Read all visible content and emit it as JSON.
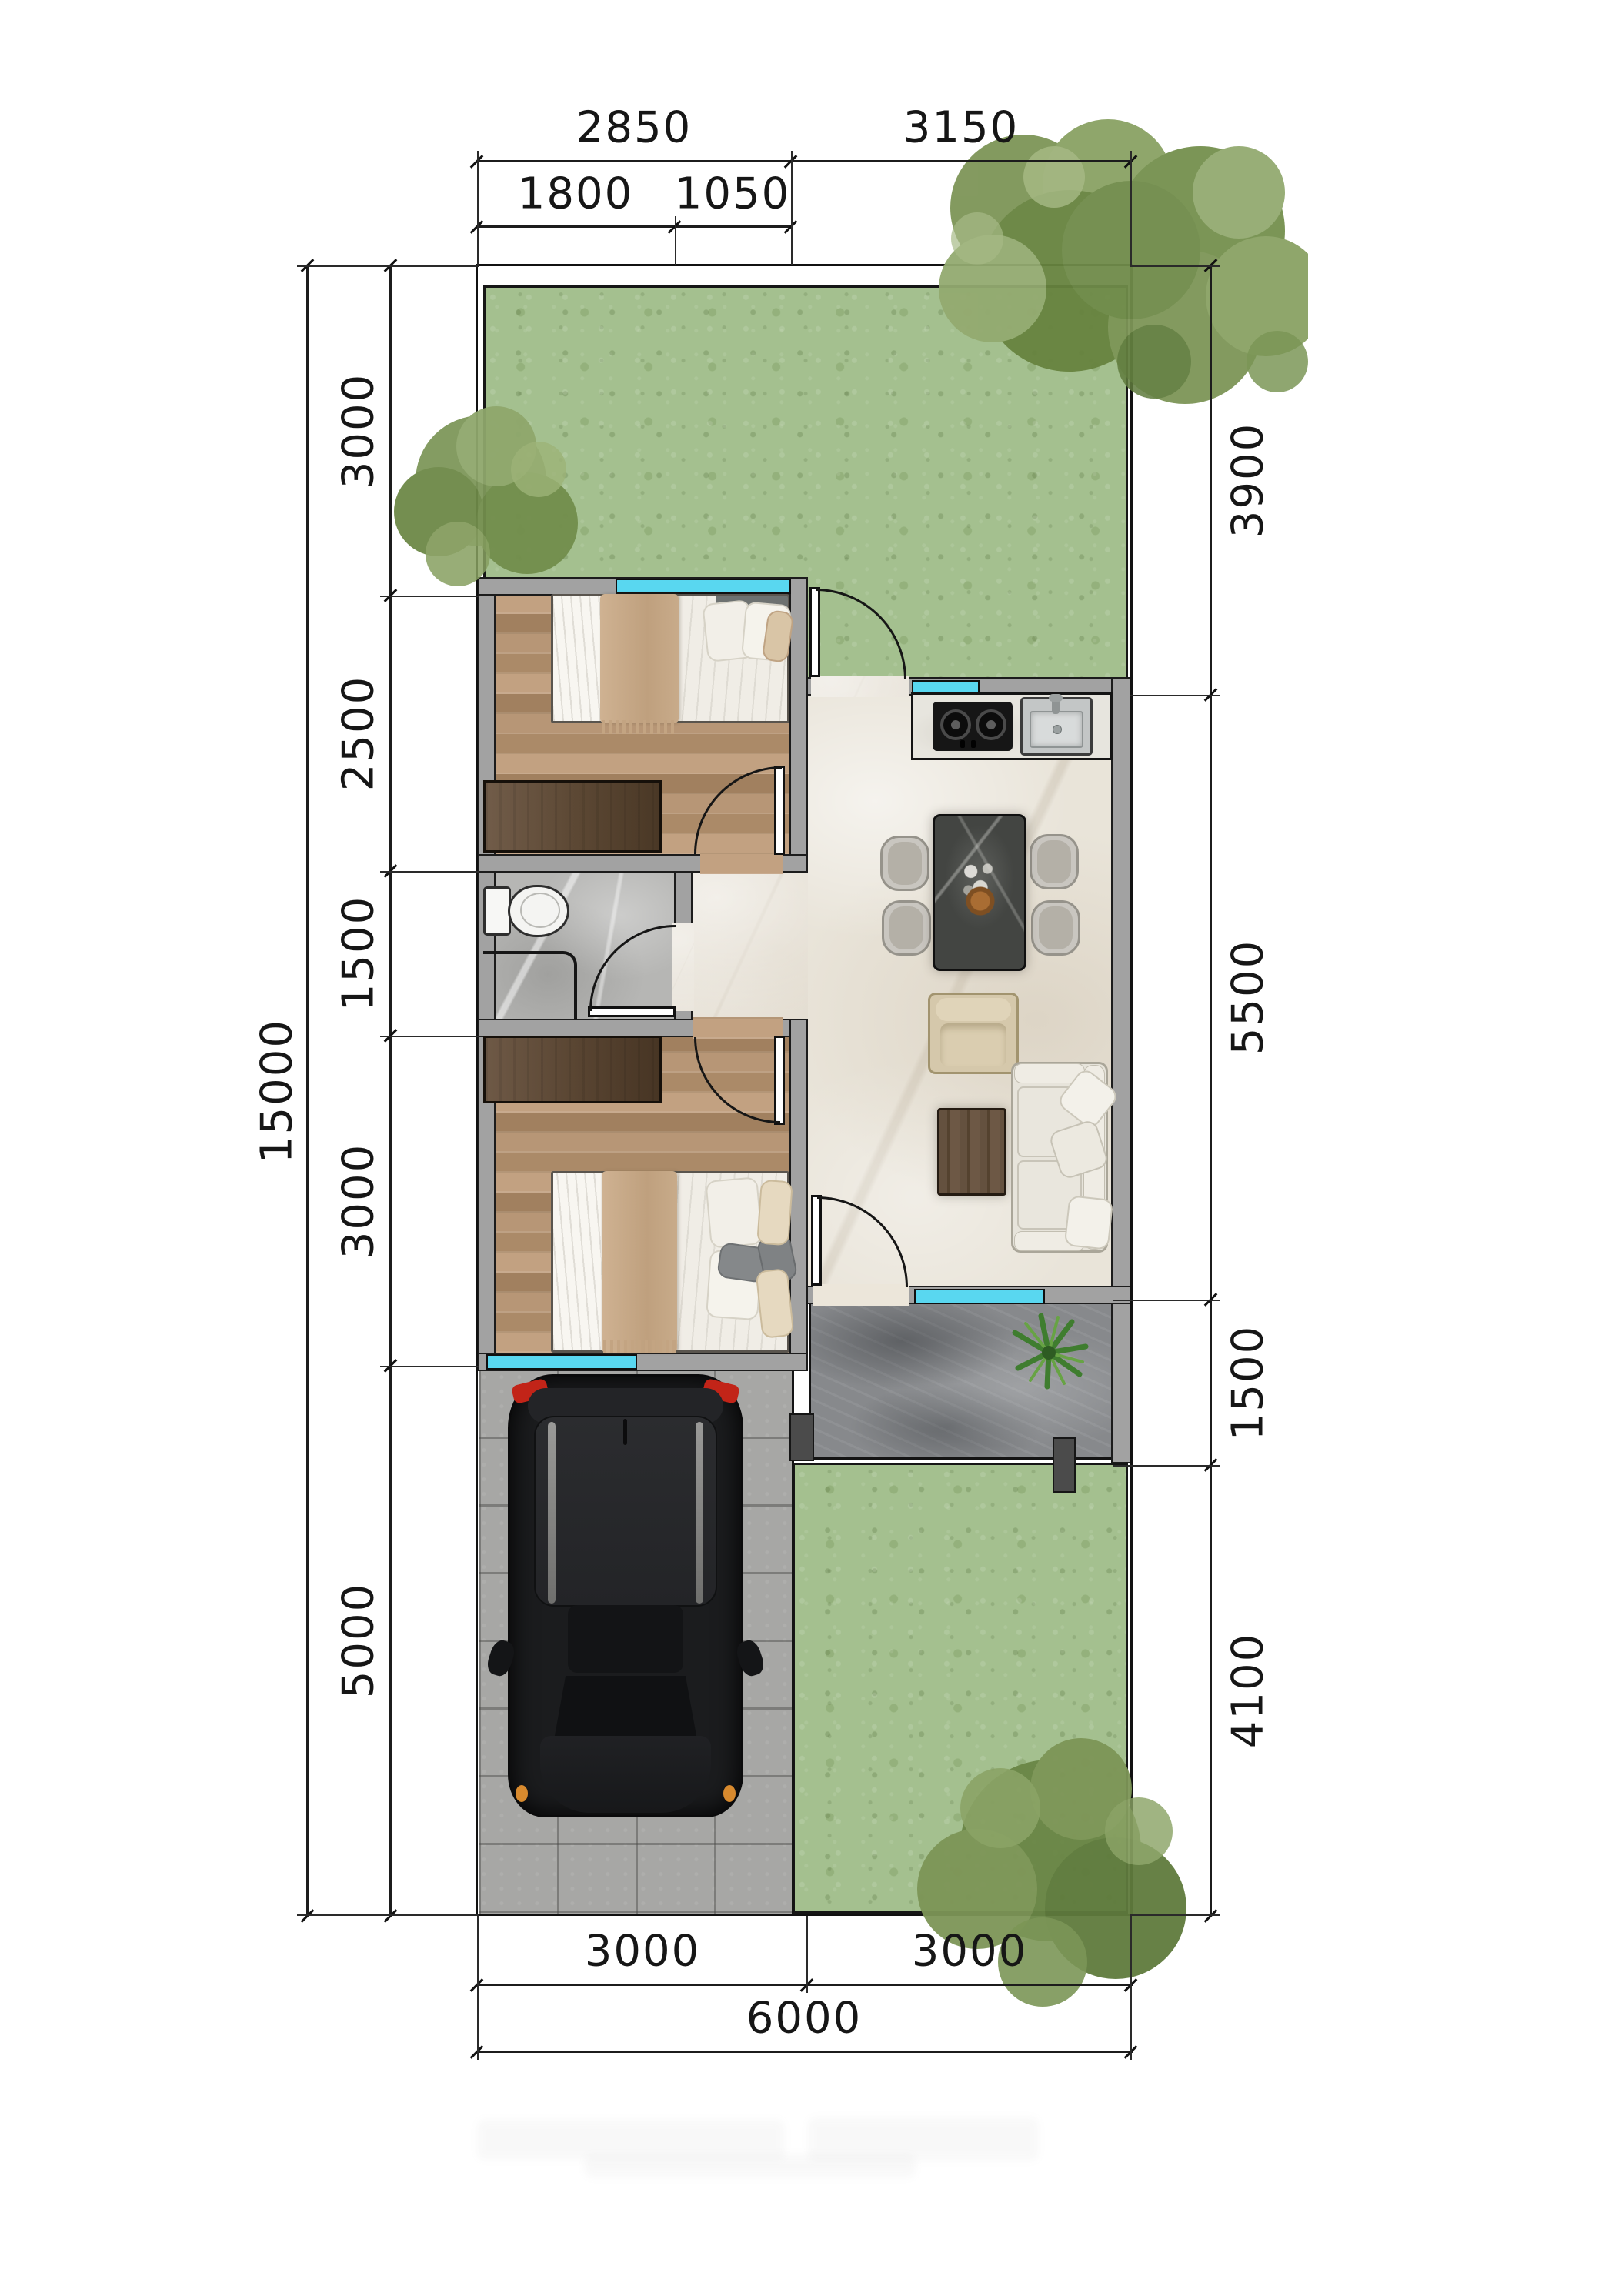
{
  "dims": {
    "top_row1": [
      "2850",
      "3150"
    ],
    "top_row2": [
      "1800",
      "1050"
    ],
    "left_overall": "15000",
    "left_segments": [
      "3000",
      "2500",
      "1500",
      "3000",
      "5000"
    ],
    "right_segments": [
      "3900",
      "5500",
      "1500",
      "4100"
    ],
    "bottom_row1": [
      "3000",
      "3000"
    ],
    "bottom_overall": "6000"
  },
  "colors": {
    "window_glass": "#59d7f0",
    "grass": "#a4c08f",
    "tree_foliage": "#75904f",
    "wall_fill": "#a2a2a2",
    "wood_floor": "#b3926f",
    "marble_floor": "#e9e4d9",
    "bath_floor": "#b6b6b4",
    "terrace_stone": "#87898c",
    "carport_paver": "#a7a7a5",
    "car_body": "#1b1c1e",
    "car_taillight": "#c22418",
    "car_marker": "#d88a2e",
    "blanket": "#c7a987",
    "dimension_ink": "#161616"
  }
}
